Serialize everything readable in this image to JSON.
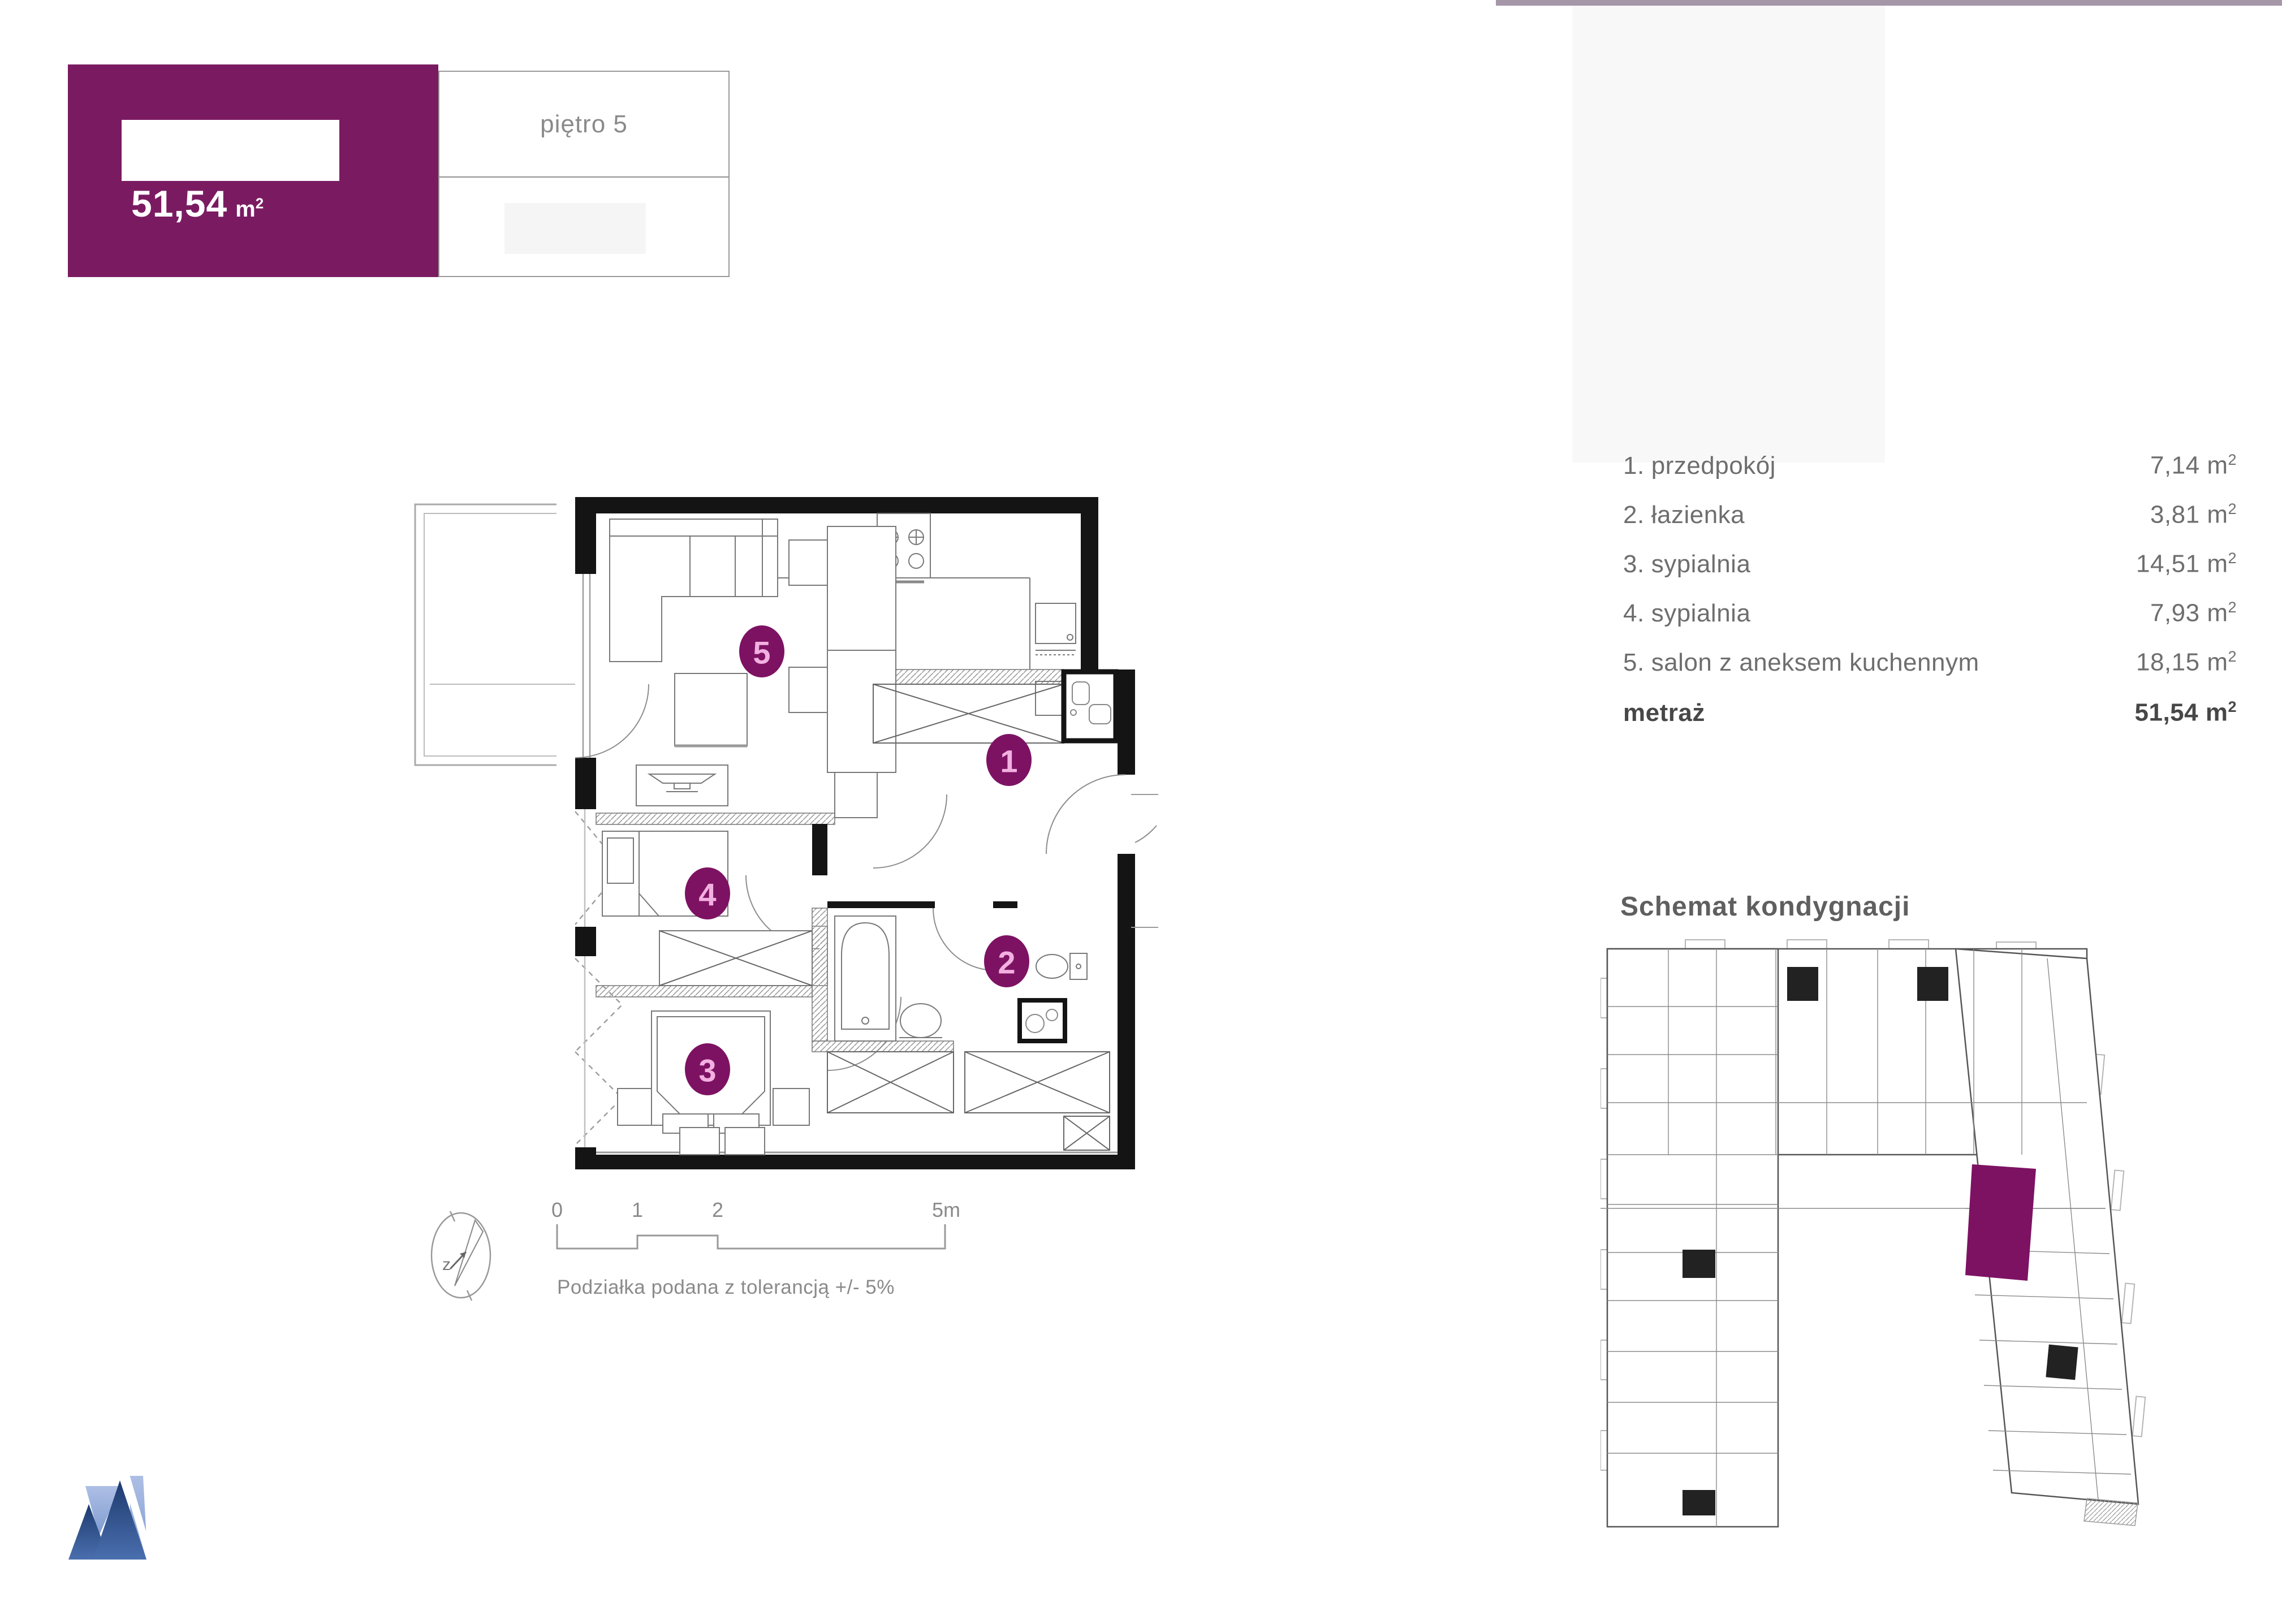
{
  "header": {
    "area_value": "51,54",
    "area_unit": "m",
    "area_sup": "2",
    "floor_label": "piętro 5"
  },
  "room_list": {
    "rows": [
      {
        "num": "1.",
        "name": "przedpokój",
        "area": "7,14",
        "unit": "m",
        "sup": "2"
      },
      {
        "num": "2.",
        "name": "łazienka",
        "area": "3,81",
        "unit": "m",
        "sup": "2"
      },
      {
        "num": "3.",
        "name": "sypialnia",
        "area": "14,51",
        "unit": "m",
        "sup": "2"
      },
      {
        "num": "4.",
        "name": "sypialnia",
        "area": "7,93",
        "unit": "m",
        "sup": "2"
      },
      {
        "num": "5.",
        "name": "salon z aneksem kuchennym",
        "area": "18,15",
        "unit": "m",
        "sup": "2"
      }
    ],
    "total": {
      "name": "metraż",
      "area": "51,54",
      "unit": "m",
      "sup": "2"
    }
  },
  "plan": {
    "badges": {
      "b1": "1",
      "b2": "2",
      "b3": "3",
      "b4": "4",
      "b5": "5"
    },
    "scale": {
      "t0": "0",
      "t1": "1",
      "t2": "2",
      "t3": "5m",
      "note": "Podziałka podana z tolerancją +/- 5%",
      "compass": "z"
    }
  },
  "scheme": {
    "title": "Schemat kondygnacji"
  },
  "colors": {
    "accent": "#7a1b61",
    "badge": "#7d1263",
    "badge_text": "#f2b0e0",
    "wall": "#141414",
    "top_bar": "#a596a8",
    "logo_dark": "#27457f",
    "logo_light": "#9db4dd"
  }
}
